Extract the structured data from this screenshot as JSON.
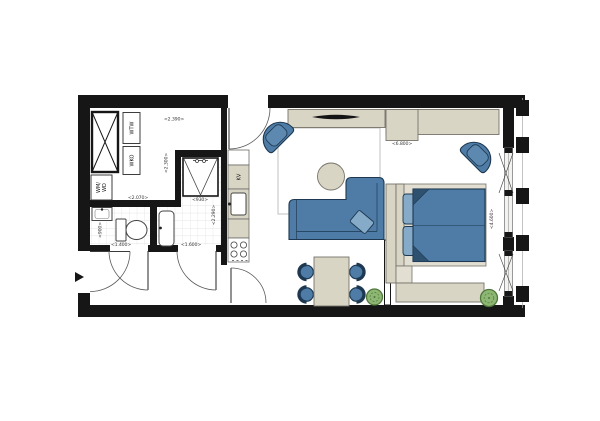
{
  "floor_plan": {
    "type": "apartment-floor-plan",
    "labels": {
      "wtw": "WTW",
      "wko": "WKO",
      "wm_wd_lines": [
        "WM/",
        "WD"
      ],
      "kv": "KV"
    },
    "dimensions": {
      "utility_width": "<2.390>",
      "utility_height": "<2.300>",
      "utility_bottom_width": "<2.070>",
      "shower_width": "<930>",
      "shower_room_height": "<2.290>",
      "toilet_room_height": "<900>",
      "toilet_room_width": "<1.400>",
      "shower_room_width": "<1.600>",
      "living_bedroom_width": "<6.800>",
      "bedroom_depth": "<4.600>"
    },
    "colors": {
      "wall": "#161616",
      "furniture_blue": "#4e7ca6",
      "furniture_blue_dark": "#1d3850",
      "cushion_blue": "#86abc9",
      "duvet_fold": "#2e5170",
      "beige": "#d9d5c5",
      "beige_light": "#e2dfd2",
      "plant_green": "#8db773",
      "plant_green_dark": "#50783c",
      "tile_line": "#dcdcdc",
      "rug_line": "#c6c6c3",
      "dimension_text": "#3a3a3a"
    }
  }
}
